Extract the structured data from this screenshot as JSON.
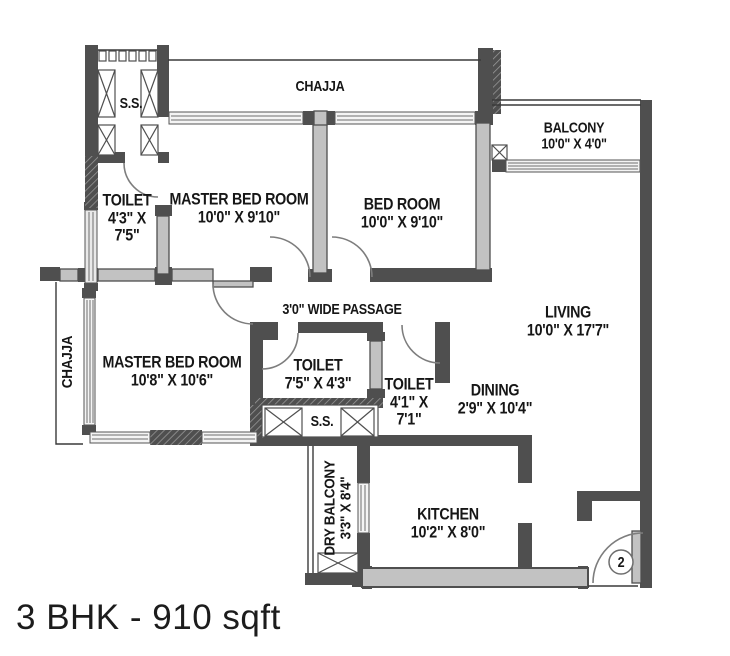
{
  "title": "3 BHK - 910 sqft",
  "plan": {
    "rooms": {
      "master_bed_1": {
        "name": "MASTER BED ROOM",
        "dims": "10'0\" X 9'10\""
      },
      "bed_room": {
        "name": "BED ROOM",
        "dims": "10'0\" X 9'10\""
      },
      "master_bed_2": {
        "name": "MASTER BED ROOM",
        "dims": "10'8\" X 10'6\""
      },
      "living": {
        "name": "LIVING",
        "dims": "10'0\" X 17'7\""
      },
      "dining": {
        "name": "DINING",
        "dims": "2'9\" X 10'4\""
      },
      "kitchen": {
        "name": "KITCHEN",
        "dims": "10'2\" X 8'0\""
      },
      "balcony": {
        "name": "BALCONY",
        "dims": "10'0\" X 4'0\""
      },
      "dry_balcony": {
        "name": "DRY BALCONY",
        "dims": "3'3\" X 8'4\""
      },
      "toilet_top": {
        "name": "TOILET",
        "dims_l1": "4'3\" X",
        "dims_l2": "7'5\""
      },
      "toilet_mid": {
        "name": "TOILET",
        "dims": "7'5\" X 4'3\""
      },
      "toilet_right": {
        "name": "TOILET",
        "dims_l1": "4'1\" X",
        "dims_l2": "7'1\""
      },
      "passage": {
        "name": "3'0\" WIDE PASSAGE"
      },
      "chajja_top": {
        "name": "CHAJJA"
      },
      "chajja_left": {
        "name": "CHAJJA"
      },
      "ss_top": {
        "name": "S.S."
      },
      "ss_mid": {
        "name": "S.S."
      },
      "entrance": {
        "number": "2"
      }
    },
    "colors": {
      "wall": "#4f4f4f",
      "wall_fill": "#c2c2c2",
      "window_line": "#6e6e6e",
      "text": "#161616"
    }
  }
}
